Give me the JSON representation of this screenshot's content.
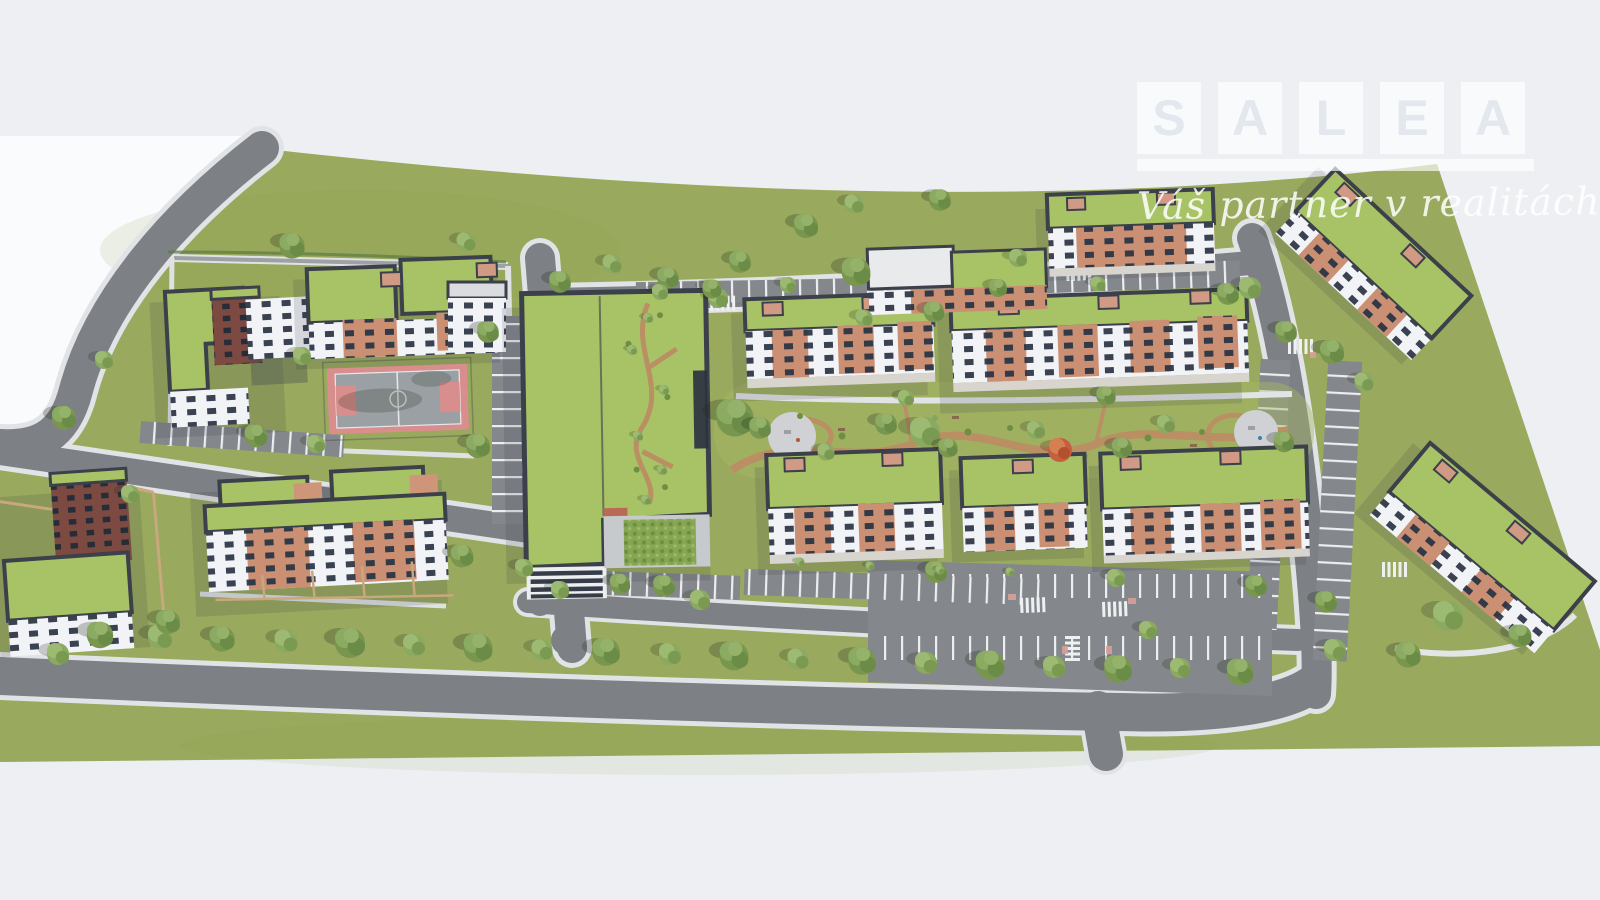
{
  "watermark": {
    "brand_name": "SALEA",
    "brand_letters": [
      "S",
      "A",
      "L",
      "E",
      "A"
    ],
    "tagline": "Váš partner v realitách"
  },
  "palette": {
    "background": "#edeff3",
    "offsite": "#fafbfd",
    "grass": "#99a95d",
    "road": "#7d8084",
    "road_edge": "#e2e3e6",
    "parking": "#84878b",
    "stall_line": "#eceef0",
    "green_roof": "#a8c365",
    "roof_edge": "#3b404b",
    "facade_white": "#f2f3f6",
    "window": "#3a4150",
    "facade_brick": "#cb9073",
    "facade_maroon": "#7d4a42",
    "park_path": "#b98f63",
    "court_border": "#d98e8e",
    "court_surface": "#9aa0a4",
    "living_wall": "#86a653",
    "tree_green": "#78964e",
    "autumn_tree": "#c4603f"
  }
}
